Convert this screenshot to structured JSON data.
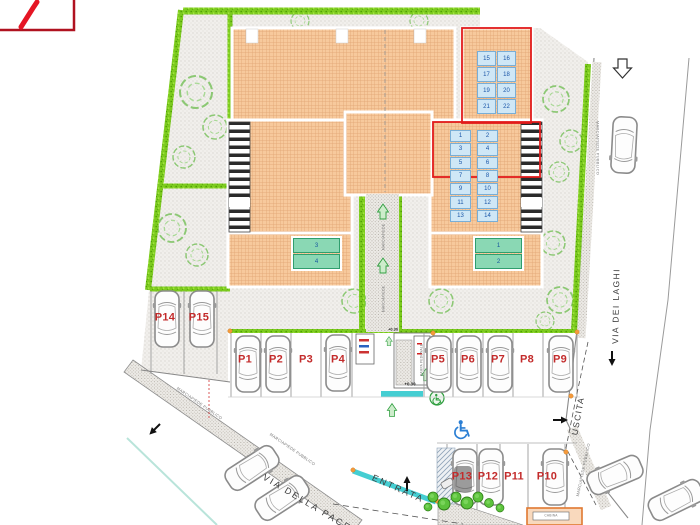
{
  "parking": {
    "label_color": "#c32b2b",
    "row_main": [
      "P1",
      "P2",
      "P3",
      "P4",
      "P5",
      "P6",
      "P7",
      "P8",
      "P9"
    ],
    "row_side": [
      "P14",
      "P15"
    ],
    "row_bottom": [
      "P13",
      "P12",
      "P11",
      "P10"
    ]
  },
  "units": {
    "block_top_right": [
      "15",
      "16",
      "17",
      "18",
      "19",
      "20",
      "21",
      "22"
    ],
    "block_middle_left": [
      "1",
      "3",
      "5",
      "7",
      "9",
      "11",
      "13"
    ],
    "block_middle_right": [
      "2",
      "4",
      "6",
      "8",
      "10",
      "12",
      "14"
    ],
    "patio_left": [
      "3",
      "4"
    ],
    "patio_right": [
      "1",
      "2"
    ]
  },
  "labels": {
    "entrance": "ENTRATA",
    "exit": "USCITA",
    "street_bottom": "VIA DELLA PACE",
    "street_right": "VIA DEI LAGHI",
    "sidewalk": "MARCIAPIEDE PUBBLICO",
    "walkway": "MARCIAPIEDE",
    "ramp": "RAMPA PEDONALE",
    "level": "+0.30",
    "cabin": "CABINA"
  },
  "colors": {
    "roof": "#f7c99c",
    "hedge": "#7ccb1e",
    "red_outline": "#e21b1b",
    "unit_cell": "#cfe7f6",
    "unit_text": "#1a56a8",
    "patio_cell": "#8ad8b4",
    "gate_cyan": "#45ced2",
    "marker_orange": "#f59a3c",
    "handicap_blue": "#2b7fd4"
  }
}
